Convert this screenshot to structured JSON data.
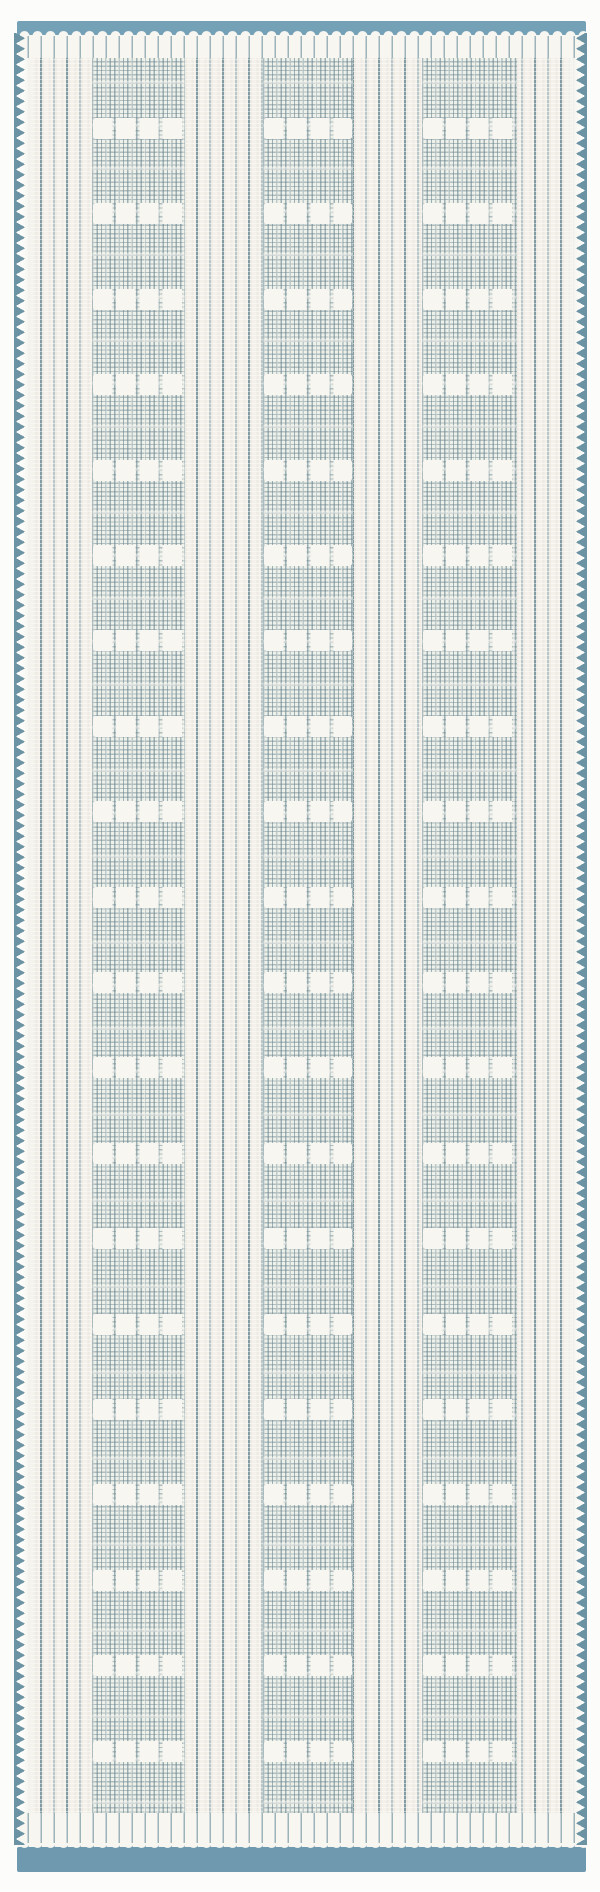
{
  "image": {
    "description": "Product photo of a vertical flat-weave runner rug: ivory ground with thin steel-blue pinstripes, three windowpane-grid panels containing repeating rows of four white blocks, solid blue bands across both ends, scalloped white thread ends at the bands, and zigzag blue selvedge stitching along both long edges.",
    "width_px": 600,
    "height_px": 1892
  },
  "theme": {
    "photo-bg": "#fcfcfa",
    "ivory": "#f3f1ea",
    "ivory-bright": "#f7f6f1",
    "band-top": "#75a1b7",
    "band-bottom": "#6e99ae",
    "stripe": "#8fa8b0",
    "grid-line": "#6c8893",
    "square": "#f7f6f1",
    "selvedge": "#6b93a3",
    "rib-gap": "#9cb3ba"
  },
  "rug": {
    "left": 16,
    "top": 21,
    "width": 573,
    "height": 1851,
    "top_band": {
      "height": 14
    },
    "bottom_band": {
      "height": 25
    },
    "pinstripe_spacing_px": 13,
    "grid_cell_px": 4.4,
    "grid_columns": [
      {
        "left": 76,
        "width": 93
      },
      {
        "left": 247,
        "width": 90
      },
      {
        "left": 406,
        "width": 95
      }
    ],
    "block_rows": {
      "count": 21,
      "start": 81,
      "period": 85.4,
      "height": 21,
      "squares_per_row": 4
    },
    "selvedge_tooth_period_px": 10.5
  }
}
